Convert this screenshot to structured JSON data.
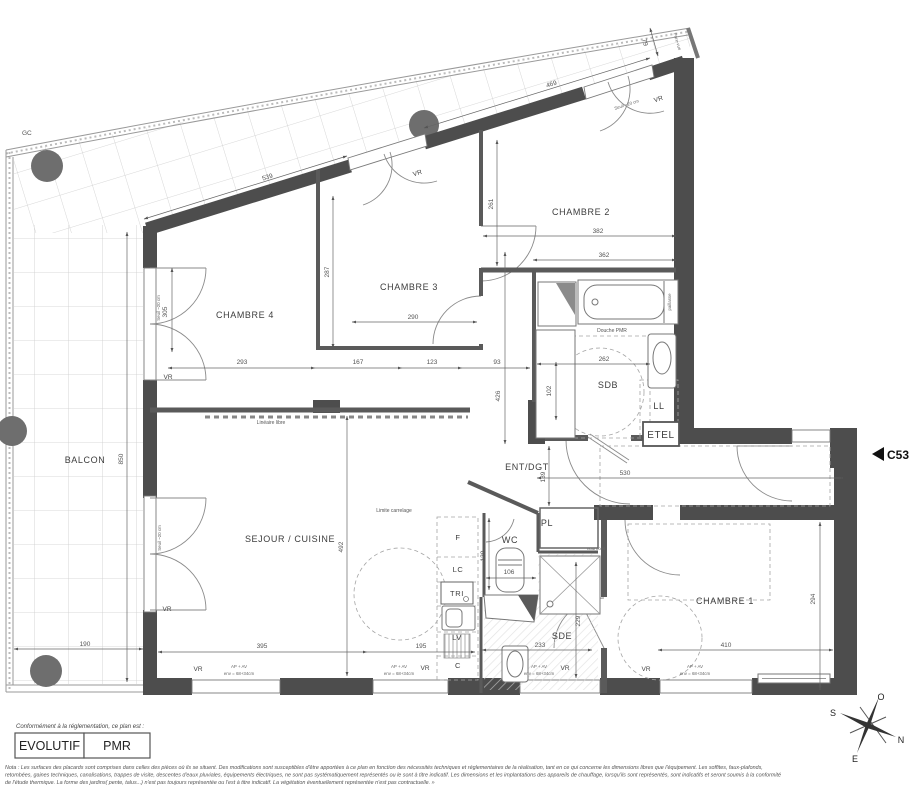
{
  "plan": {
    "code": "C53",
    "gc": "GC"
  },
  "rooms": {
    "chambre1": "CHAMBRE 1",
    "chambre2": "CHAMBRE 2",
    "chambre3": "CHAMBRE 3",
    "chambre4": "CHAMBRE 4",
    "sejour": "SEJOUR / CUISINE",
    "balcon": "BALCON",
    "sdb": "SDB",
    "sde": "SDE",
    "wc": "WC",
    "ent": "ENT/DGT",
    "pl": "PL",
    "etel": "ETEL",
    "ll": "LL",
    "lv": "LV",
    "tri": "TRI",
    "lc": "LC",
    "f": "F",
    "c": "C"
  },
  "annotations": {
    "vr": "VR",
    "ap_av_1": "AP + AV",
    "ap_av_2": "env = 68+34cm",
    "seuil": "Seuil ~20 cm",
    "pare_vue": "Pare-vue",
    "limite_carrelage": "Limite carrelage",
    "lineaire_libre": "Linéaire libre",
    "douche_pmr": "Douche PMR",
    "nourrices": "nourrices",
    "paillasse": "paillasse"
  },
  "dims": {
    "d539": "539",
    "d469": "469",
    "d79": "79",
    "d305": "305",
    "d293": "293",
    "d167": "167",
    "d123": "123",
    "d93": "93",
    "d287": "287",
    "d290": "290",
    "d261": "261",
    "d382": "382",
    "d362": "362",
    "d262": "262",
    "d102": "102",
    "d426": "426",
    "d139": "139",
    "d530": "530",
    "d492": "492",
    "d850": "850",
    "d190": "190",
    "d395": "395",
    "d195": "195",
    "d130": "130",
    "d106": "106",
    "d233": "233",
    "d229": "229",
    "d410": "410",
    "d294": "294"
  },
  "compass": {
    "n": "N",
    "s": "S",
    "e": "E",
    "o": "O"
  },
  "legend": {
    "intro": "Conformément à la réglementation, ce plan est :",
    "evolutif": "EVOLUTIF",
    "pmr": "PMR"
  },
  "footer": {
    "line1": "Nota : Les surfaces des placards sont comprises dans celles des pièces où ils se situent. Des modifications sont susceptibles d'être apportées à ce plan en fonction des nécessités techniques et réglementaires de la réalisation, tant en ce qui concerne les dimensions libres que l'équipement.  Les soffites, faux-plafonds,",
    "line2": "retombées, gaines techniques, canalisations, trappes de visite, descentes d'eaux pluviales, équipements électriques, ne sont pas systématiquement représentés ou le sont à titre indicatif. Les dimensions et les implantations des appareils de chauffage, lorsqu'ils sont représentés, sont indicatifs et seront soumis à la conformité",
    "line3": "de l'étude thermique. La forme des jardins( pente, talus...) n'est pas toujours représentée ou l'est à titre indicatif. La végétation éventuellement représentée n'est pas contractuelle. »"
  }
}
